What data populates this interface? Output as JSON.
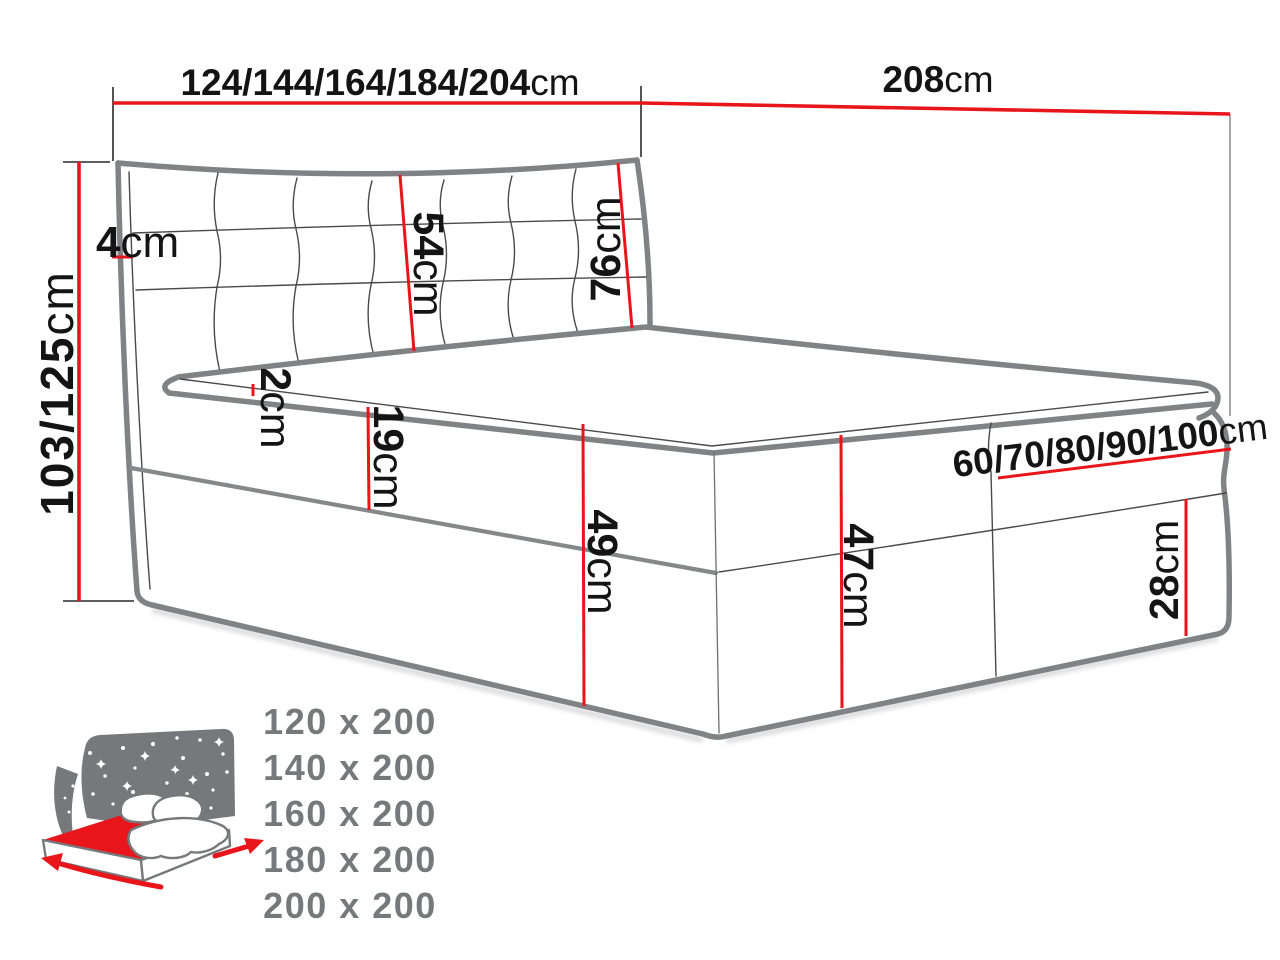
{
  "dimensions": {
    "width_options": {
      "value": "124/144/164/184/204",
      "unit": "cm"
    },
    "length_total": {
      "value": "208",
      "unit": "cm"
    },
    "height_options": {
      "value": "103/125",
      "unit": "cm"
    },
    "frame_thickness": {
      "value": "4",
      "unit": "cm"
    },
    "headboard_cushion_height": {
      "value": "54",
      "unit": "cm"
    },
    "headboard_height": {
      "value": "76",
      "unit": "cm"
    },
    "mattress_lip": {
      "value": "2",
      "unit": "cm"
    },
    "upper_box_height": {
      "value": "19",
      "unit": "cm"
    },
    "side_height": {
      "value": "49",
      "unit": "cm"
    },
    "foot_end_height": {
      "value": "47",
      "unit": "cm"
    },
    "half_width_options": {
      "value": "60/70/80/90/100",
      "unit": "cm"
    },
    "lower_box_height": {
      "value": "28",
      "unit": "cm"
    }
  },
  "legend": {
    "sizes": [
      "120 x 200",
      "140 x 200",
      "160 x 200",
      "180 x 200",
      "200 x 200"
    ]
  },
  "colors": {
    "dimension_red": "#e8151b",
    "outline_gray": "#808285",
    "legend_gray": "#77787b"
  }
}
